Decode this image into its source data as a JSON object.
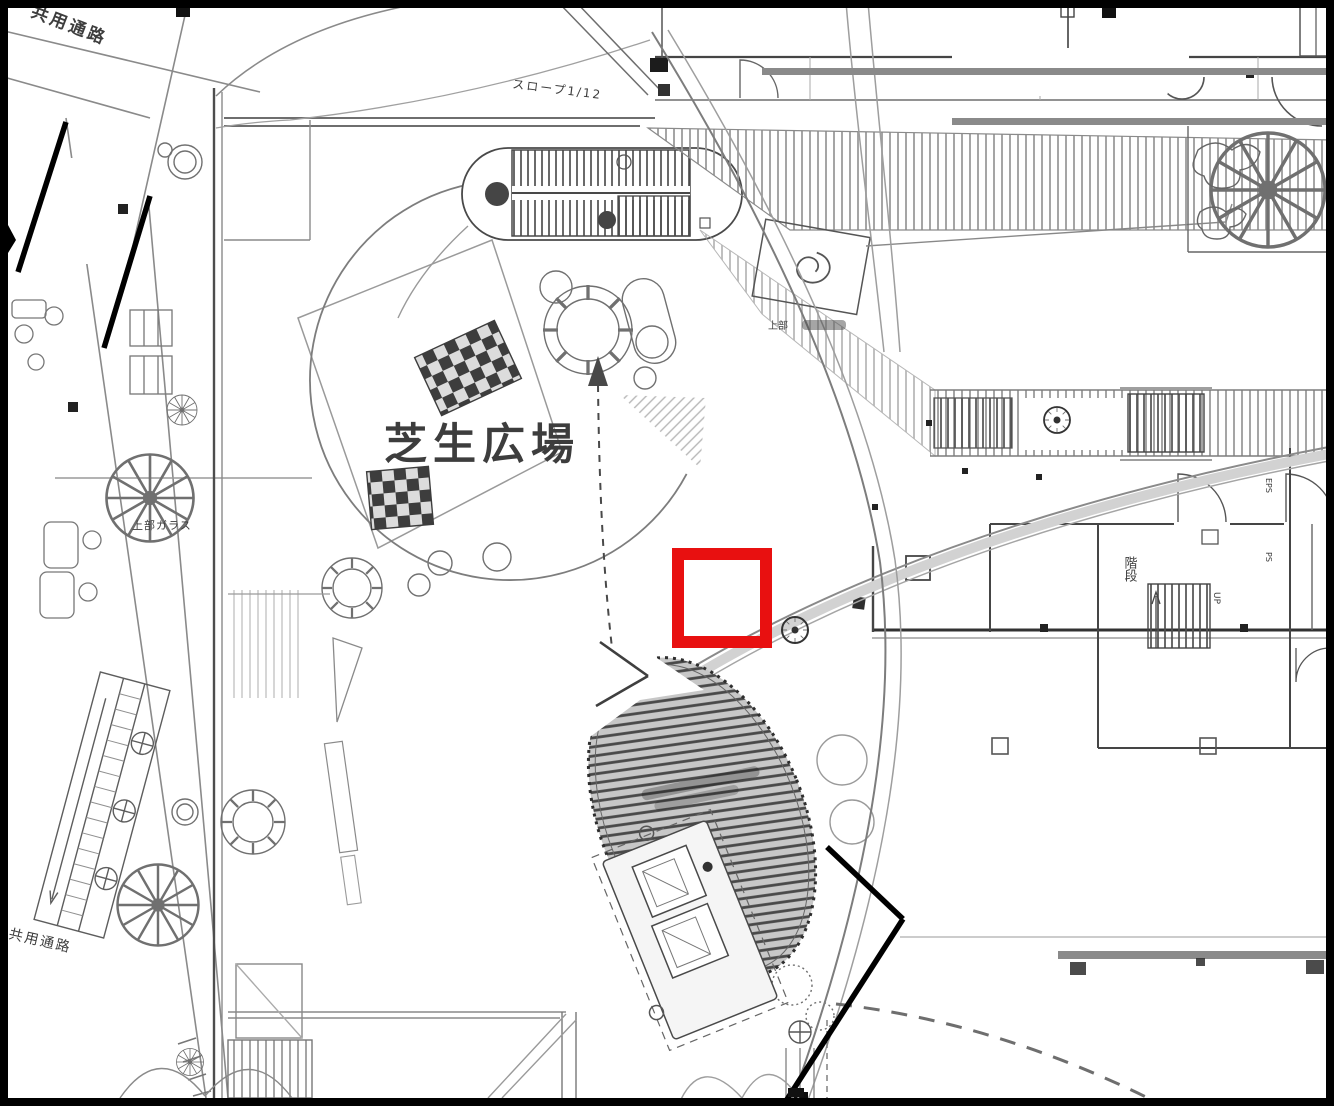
{
  "labels": {
    "lawn_plaza": "芝生広場",
    "shared_passage_top": "共用通路",
    "shared_passage_bottom": "共用通路",
    "glass_above": "上部ガラス",
    "slope": "スロープ1/12",
    "stairs": "階段",
    "up": "UP",
    "eps": "EPS",
    "ps": "PS",
    "upper_note": "上部"
  },
  "annotation": {
    "type": "highlight-square",
    "color": "#e81010",
    "x": 672,
    "y": 548,
    "size": 100,
    "stroke": 12
  },
  "colors": {
    "paper": "#ffffff",
    "scan_ink": "#4a4a4a",
    "frame": "#000000",
    "copier_bar": "#8a8a8a",
    "annotation_red": "#e81010"
  }
}
